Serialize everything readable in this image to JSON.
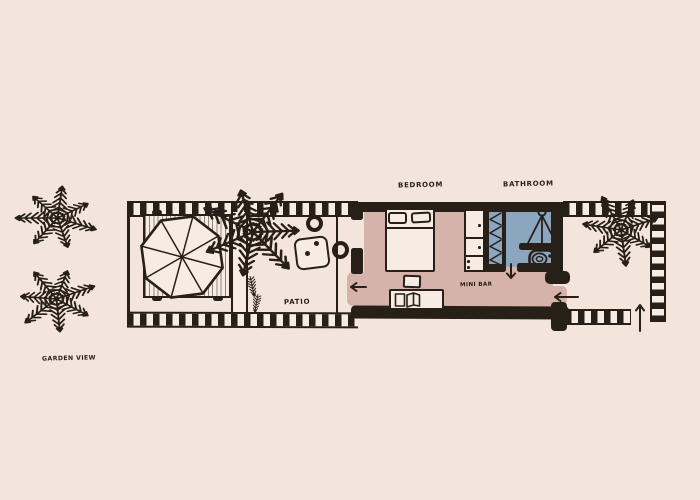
{
  "title": "Hand-drawn villa floor plan with garden view",
  "colors": {
    "background": "#f4e5dc",
    "ink": "#262019",
    "paper": "#f7ece3",
    "bedroom_floor": "#d5b3ab",
    "bathroom_floor": "#8ba6bf"
  },
  "labels": {
    "bedroom": "BEDROOM",
    "bathroom": "BATHROOM",
    "patio": "PATIO",
    "mini_bar": "MINI BAR",
    "garden_view": "GARDEN VIEW"
  },
  "rooms": [
    {
      "id": "patio",
      "label": "PATIO",
      "fill": "#f4e5dc",
      "features": [
        "daybed",
        "umbrella",
        "palm-planter",
        "side-table",
        "stool",
        "stool"
      ]
    },
    {
      "id": "bedroom",
      "label": "BEDROOM",
      "fill": "#d5b3ab",
      "features": [
        "double-bed",
        "two-pillows",
        "wardrobe",
        "desk",
        "chair",
        "mini-bar"
      ]
    },
    {
      "id": "bathroom",
      "label": "BATHROOM",
      "fill": "#8ba6bf",
      "features": [
        "shower",
        "toilet",
        "louver-shelf"
      ]
    }
  ],
  "arrows": [
    {
      "id": "patio-exit",
      "direction": "left"
    },
    {
      "id": "bathroom-door",
      "direction": "down"
    },
    {
      "id": "side-entrance",
      "direction": "left"
    },
    {
      "id": "garden-entrance",
      "direction": "up"
    }
  ],
  "decorations": {
    "palm_trees_garden_left": 2,
    "palm_trees_patio": 1,
    "palm_trees_right": 1,
    "border_style": "checkered-filmstrip"
  }
}
